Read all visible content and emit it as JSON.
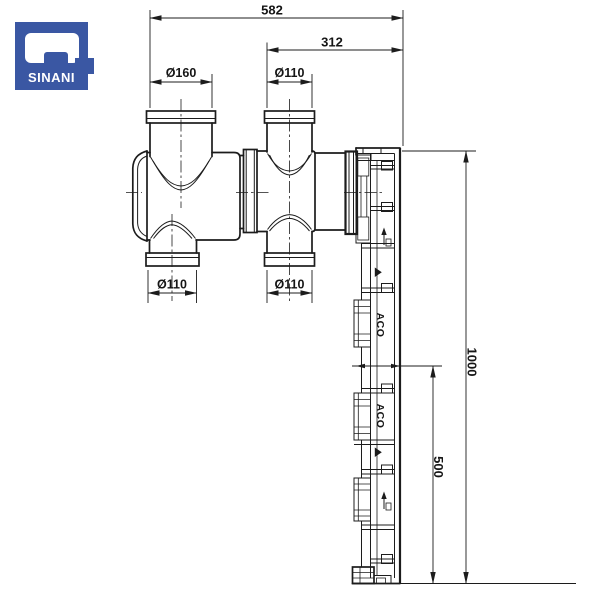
{
  "logo": {
    "brand": "SINANI",
    "bg_color": "#3A57A3",
    "text_color": "#ffffff"
  },
  "drawing": {
    "line_color": "#1c1c1c",
    "dimensions": {
      "overall_width": "582",
      "right_section_width": "312",
      "inlet_top_left": "Ø160",
      "inlet_top_right": "Ø110",
      "outlet_bottom_left": "Ø110",
      "outlet_bottom_right": "Ø110",
      "channel_length": "1000",
      "channel_half_length": "500"
    },
    "channel": {
      "brand_marks": [
        "ACO",
        "ACO"
      ]
    }
  }
}
